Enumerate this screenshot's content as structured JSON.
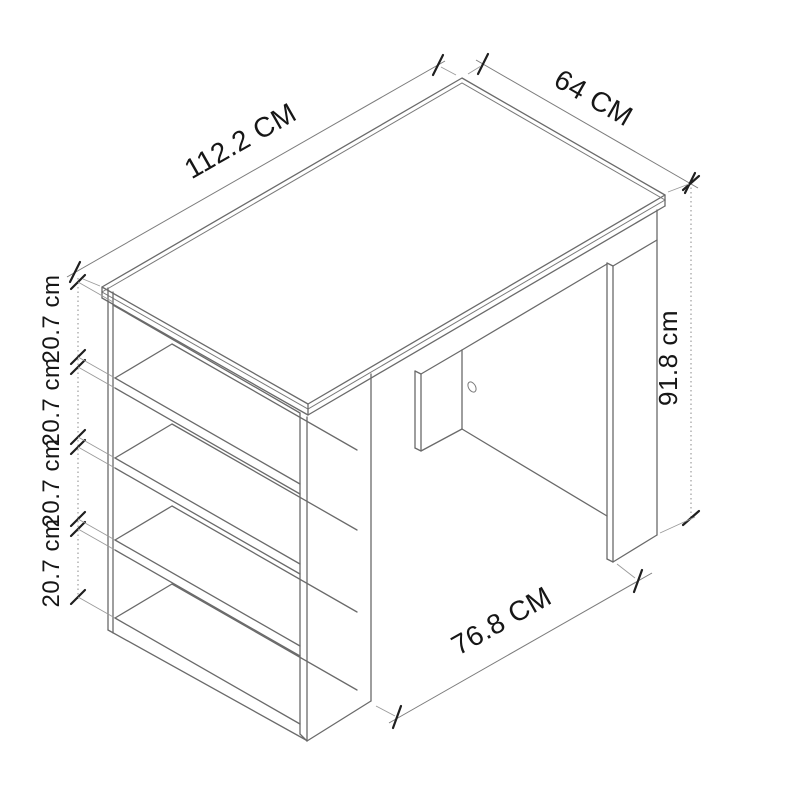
{
  "diagram": {
    "dimensions": {
      "length": "112.2 CM",
      "depth": "64 CM",
      "height": "91.8 cm",
      "clearance": "76.8 CM",
      "shelf_gaps": [
        "20.7 cm",
        "20.7 cm",
        "20.7 cm",
        "20.7 cm"
      ]
    },
    "colors": {
      "furniture_line": "#6a6a6a",
      "dimension_line": "#7c7c7c",
      "tick": "#1f1f1f",
      "text": "#161616",
      "background": "#ffffff"
    }
  }
}
